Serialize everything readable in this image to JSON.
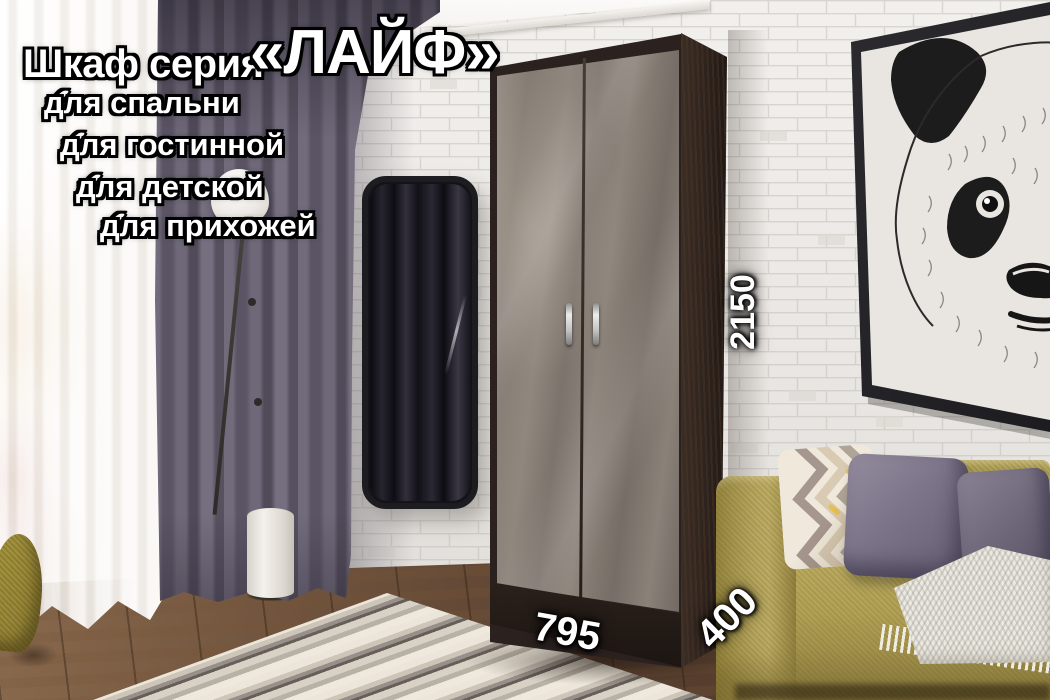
{
  "title": {
    "prefix": "Шкаф серия",
    "series": "«ЛАЙФ»"
  },
  "features": [
    {
      "icon": "✔",
      "label": "для спальни"
    },
    {
      "icon": "✔",
      "label": "для гостинной"
    },
    {
      "icon": "✔",
      "label": "для детской"
    },
    {
      "icon": "✔",
      "label": "для прихожей"
    }
  ],
  "dimensions": {
    "height_mm": "2150",
    "width_mm": "795",
    "depth_mm": "400"
  },
  "palette": {
    "overlay_text": "#ffffff",
    "overlay_outline": "#000000",
    "wardrobe_door_gloss": "#8a8179",
    "wardrobe_carcass_wenge": "#2b2220",
    "sofa_mustard": "#b2a257",
    "pillow_purple": "#7c7489",
    "curtain_gray_violet": "#5f5a68",
    "brick_wall": "#f1efec",
    "wood_floor": "#5c4332"
  }
}
